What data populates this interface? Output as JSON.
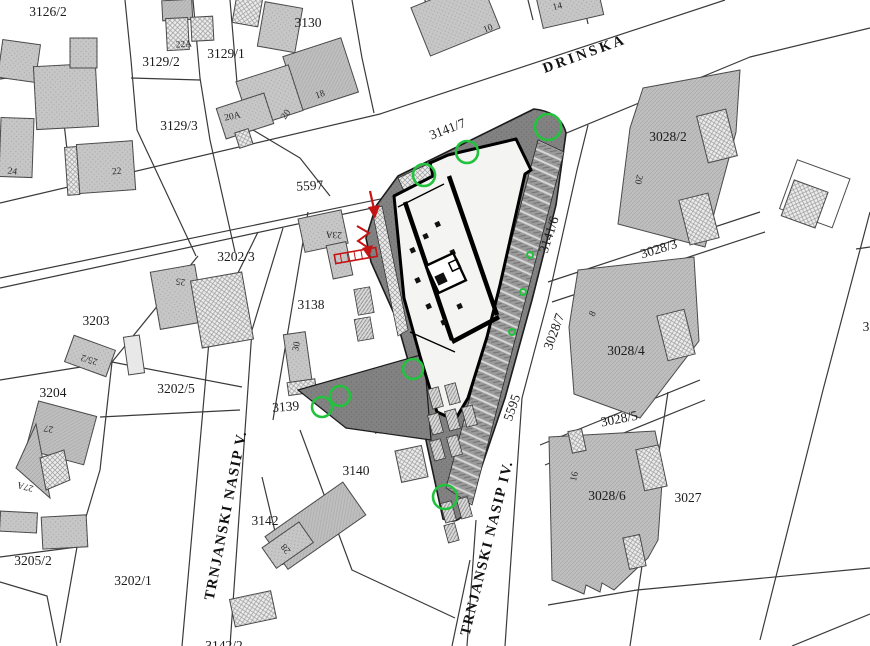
{
  "map": {
    "title": "cadastral-site-plan",
    "colors": {
      "line": "#3a3a3a",
      "site_gray": "#7f7f7f",
      "building_gray": "#c4c4c4",
      "tree_green": "#22c23e",
      "marker_red": "#c41414",
      "paper": "#ffffff"
    },
    "street_names": [
      "DRINSKA",
      "TRNJANSKI NASIP V.",
      "TRNJANSKI NASIP IV."
    ],
    "road_parcel_numbers": [
      "5597",
      "5595",
      "3141/6",
      "3028/3",
      "3028/5"
    ],
    "labels": [
      {
        "t": "3126/2",
        "x": 48,
        "y": 16,
        "r": 0,
        "c": "p",
        "n": "parcel-label-3126-2"
      },
      {
        "t": "3129/2",
        "x": 161,
        "y": 66,
        "r": 0,
        "c": "p",
        "n": "parcel-label-3129-2"
      },
      {
        "t": "3129/1",
        "x": 226,
        "y": 58,
        "r": 0,
        "c": "p",
        "n": "parcel-label-3129-1"
      },
      {
        "t": "3130",
        "x": 308,
        "y": 27,
        "r": 0,
        "c": "p",
        "n": "parcel-label-3130"
      },
      {
        "t": "3129/3",
        "x": 179,
        "y": 130,
        "r": 0,
        "c": "p",
        "n": "parcel-label-3129-3"
      },
      {
        "t": "5597",
        "x": 310,
        "y": 190,
        "r": -3,
        "c": "p",
        "n": "road-number-5597"
      },
      {
        "t": "3141/7",
        "x": 449,
        "y": 133,
        "r": -21,
        "c": "p",
        "n": "parcel-label-3141-7"
      },
      {
        "t": "3028/2",
        "x": 668,
        "y": 141,
        "r": 0,
        "c": "p",
        "n": "parcel-label-3028-2"
      },
      {
        "t": "3028/3",
        "x": 660,
        "y": 253,
        "r": -17,
        "c": "p",
        "n": "parcel-label-3028-3"
      },
      {
        "t": "3141/6",
        "x": 553,
        "y": 236,
        "r": -72,
        "c": "p",
        "n": "road-number-3141-6"
      },
      {
        "t": "3028/7",
        "x": 558,
        "y": 333,
        "r": -70,
        "c": "p",
        "n": "parcel-label-3028-7"
      },
      {
        "t": "3028/4",
        "x": 626,
        "y": 355,
        "r": 0,
        "c": "p",
        "n": "parcel-label-3028-4"
      },
      {
        "t": "3028/5",
        "x": 620,
        "y": 423,
        "r": -11,
        "c": "p",
        "n": "parcel-label-3028-5"
      },
      {
        "t": "3028/6",
        "x": 607,
        "y": 500,
        "r": 0,
        "c": "p",
        "n": "parcel-label-3028-6"
      },
      {
        "t": "3027",
        "x": 688,
        "y": 502,
        "r": 0,
        "c": "p",
        "n": "parcel-label-3027"
      },
      {
        "t": "3202/3",
        "x": 236,
        "y": 261,
        "r": 0,
        "c": "p",
        "n": "parcel-label-3202-3"
      },
      {
        "t": "3138",
        "x": 311,
        "y": 309,
        "r": 0,
        "c": "p",
        "n": "parcel-label-3138"
      },
      {
        "t": "3203",
        "x": 96,
        "y": 325,
        "r": 0,
        "c": "p",
        "n": "parcel-label-3203"
      },
      {
        "t": "3202/5",
        "x": 176,
        "y": 393,
        "r": 0,
        "c": "p",
        "n": "parcel-label-3202-5"
      },
      {
        "t": "3139",
        "x": 286,
        "y": 411,
        "r": -4,
        "c": "p",
        "n": "parcel-label-3139"
      },
      {
        "t": "3204",
        "x": 53,
        "y": 397,
        "r": 0,
        "c": "p",
        "n": "parcel-label-3204"
      },
      {
        "t": "3205/2",
        "x": 33,
        "y": 565,
        "r": 0,
        "c": "p",
        "n": "parcel-label-3205-2"
      },
      {
        "t": "3202/1",
        "x": 133,
        "y": 585,
        "r": 0,
        "c": "p",
        "n": "parcel-label-3202-1"
      },
      {
        "t": "3140",
        "x": 356,
        "y": 475,
        "r": 0,
        "c": "p",
        "n": "parcel-label-3140"
      },
      {
        "t": "3142",
        "x": 265,
        "y": 525,
        "r": 0,
        "c": "p",
        "n": "parcel-label-3142"
      },
      {
        "t": "5595",
        "x": 516,
        "y": 409,
        "r": -71,
        "c": "p",
        "n": "road-number-5595"
      },
      {
        "t": "3",
        "x": 866,
        "y": 331,
        "r": 0,
        "c": "p",
        "n": "parcel-label-partial-3"
      },
      {
        "t": "3142/2",
        "x": 224,
        "y": 650,
        "r": 0,
        "c": "p",
        "n": "parcel-label-3142-2"
      },
      {
        "t": "22A",
        "x": 184,
        "y": 47,
        "r": -4,
        "c": "b",
        "n": "house-number-22a"
      },
      {
        "t": "20A",
        "x": 233,
        "y": 119,
        "r": -12,
        "c": "b",
        "n": "house-number-20a"
      },
      {
        "t": "20",
        "x": 288,
        "y": 116,
        "r": -55,
        "c": "b",
        "n": "house-number-20"
      },
      {
        "t": "18",
        "x": 321,
        "y": 97,
        "r": -20,
        "c": "b",
        "n": "house-number-18"
      },
      {
        "t": "24",
        "x": 12,
        "y": 174,
        "r": 8,
        "c": "b",
        "n": "house-number-24"
      },
      {
        "t": "22",
        "x": 117,
        "y": 174,
        "r": -6,
        "c": "b",
        "n": "house-number-22"
      },
      {
        "t": "10",
        "x": 489,
        "y": 31,
        "r": -22,
        "c": "b",
        "n": "house-number-10"
      },
      {
        "t": "14",
        "x": 558,
        "y": 9,
        "r": -13,
        "c": "b",
        "n": "house-number-14"
      },
      {
        "t": "25",
        "x": 181,
        "y": 279,
        "r": 188,
        "c": "b",
        "n": "house-number-25"
      },
      {
        "t": "23A",
        "x": 334,
        "y": 232,
        "r": 183,
        "c": "b",
        "n": "house-number-23a"
      },
      {
        "t": "25/2",
        "x": 90,
        "y": 357,
        "r": 197,
        "c": "b",
        "n": "house-number-25-2"
      },
      {
        "t": "30",
        "x": 299,
        "y": 347,
        "r": -78,
        "c": "b",
        "n": "house-number-30"
      },
      {
        "t": "27",
        "x": 49,
        "y": 426,
        "r": 190,
        "c": "b",
        "n": "house-number-27"
      },
      {
        "t": "27A",
        "x": 26,
        "y": 484,
        "r": 195,
        "c": "b",
        "n": "house-number-27a"
      },
      {
        "t": "28",
        "x": 288,
        "y": 547,
        "r": 232,
        "c": "b",
        "n": "house-number-28"
      },
      {
        "t": "8",
        "x": 595,
        "y": 315,
        "r": -62,
        "c": "b",
        "n": "house-number-8"
      },
      {
        "t": "16",
        "x": 577,
        "y": 477,
        "r": -77,
        "c": "b",
        "n": "house-number-16"
      },
      {
        "t": "20",
        "x": 636,
        "y": 179,
        "r": 103,
        "c": "b",
        "n": "house-number-20b"
      },
      {
        "t": "DRINSKA",
        "x": 586,
        "y": 58,
        "r": -20,
        "c": "s",
        "ls": 3,
        "n": "street-name-drinska"
      },
      {
        "t": "TRNJANSKI NASIP V.",
        "x": 230,
        "y": 516,
        "r": -79,
        "ls": 1.5,
        "c": "s",
        "n": "street-name-trnjanski-nasip-v"
      },
      {
        "t": "TRNJANSKI NASIP IV.",
        "x": 491,
        "y": 549,
        "r": -76,
        "ls": 1.5,
        "c": "s",
        "n": "street-name-trnjanski-nasip-iv"
      }
    ],
    "trees": [
      {
        "cx": 424,
        "cy": 175,
        "rr": 11
      },
      {
        "cx": 467,
        "cy": 152,
        "rr": 11
      },
      {
        "cx": 548,
        "cy": 127,
        "rr": 13
      },
      {
        "cx": 322,
        "cy": 407,
        "rr": 10
      },
      {
        "cx": 340,
        "cy": 396,
        "rr": 10
      },
      {
        "cx": 413,
        "cy": 369,
        "rr": 10
      },
      {
        "cx": 445,
        "cy": 497,
        "rr": 12
      },
      {
        "cx": 523,
        "cy": 292,
        "rr": 3
      },
      {
        "cx": 512,
        "cy": 332,
        "rr": 3
      },
      {
        "cx": 530,
        "cy": 255,
        "rr": 3
      }
    ]
  }
}
